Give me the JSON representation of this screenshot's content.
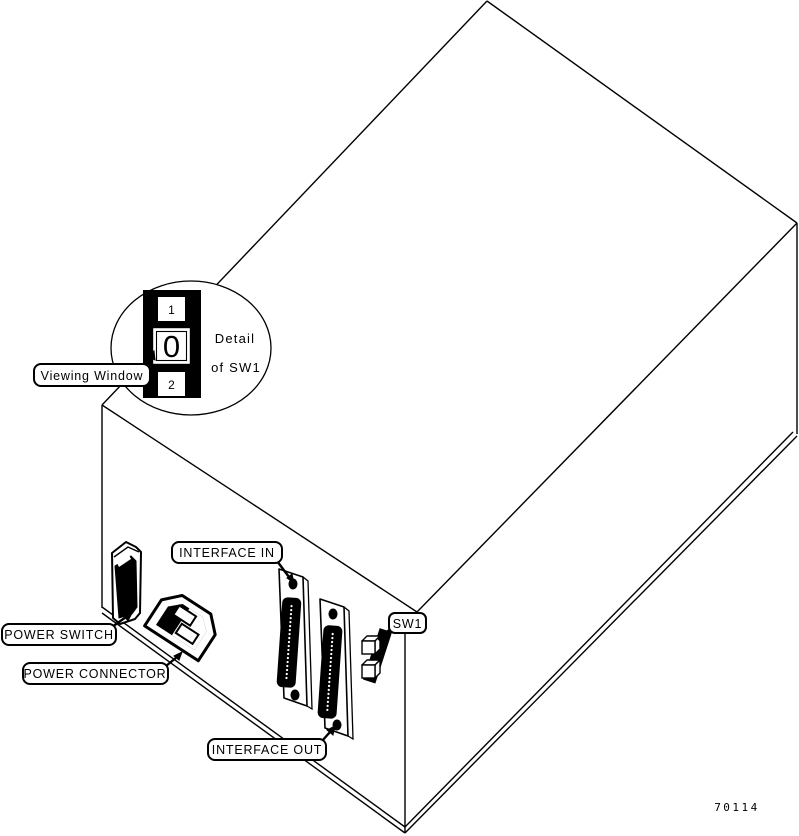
{
  "diagram": {
    "callouts": {
      "viewing_window": "Viewing Window",
      "interface_in": "INTERFACE IN",
      "power_switch": "POWER SWITCH",
      "power_connector": "POWER CONNECTOR",
      "interface_out": "INTERFACE OUT",
      "sw1": "SW1"
    },
    "detail_view": {
      "caption_line1": "Detail",
      "caption_line2": "of SW1",
      "switch_positions": {
        "top": "1",
        "middle": "0",
        "bottom": "2"
      }
    },
    "figure_number": "70114",
    "colors": {
      "ink": "#000000",
      "paper": "#ffffff"
    }
  }
}
